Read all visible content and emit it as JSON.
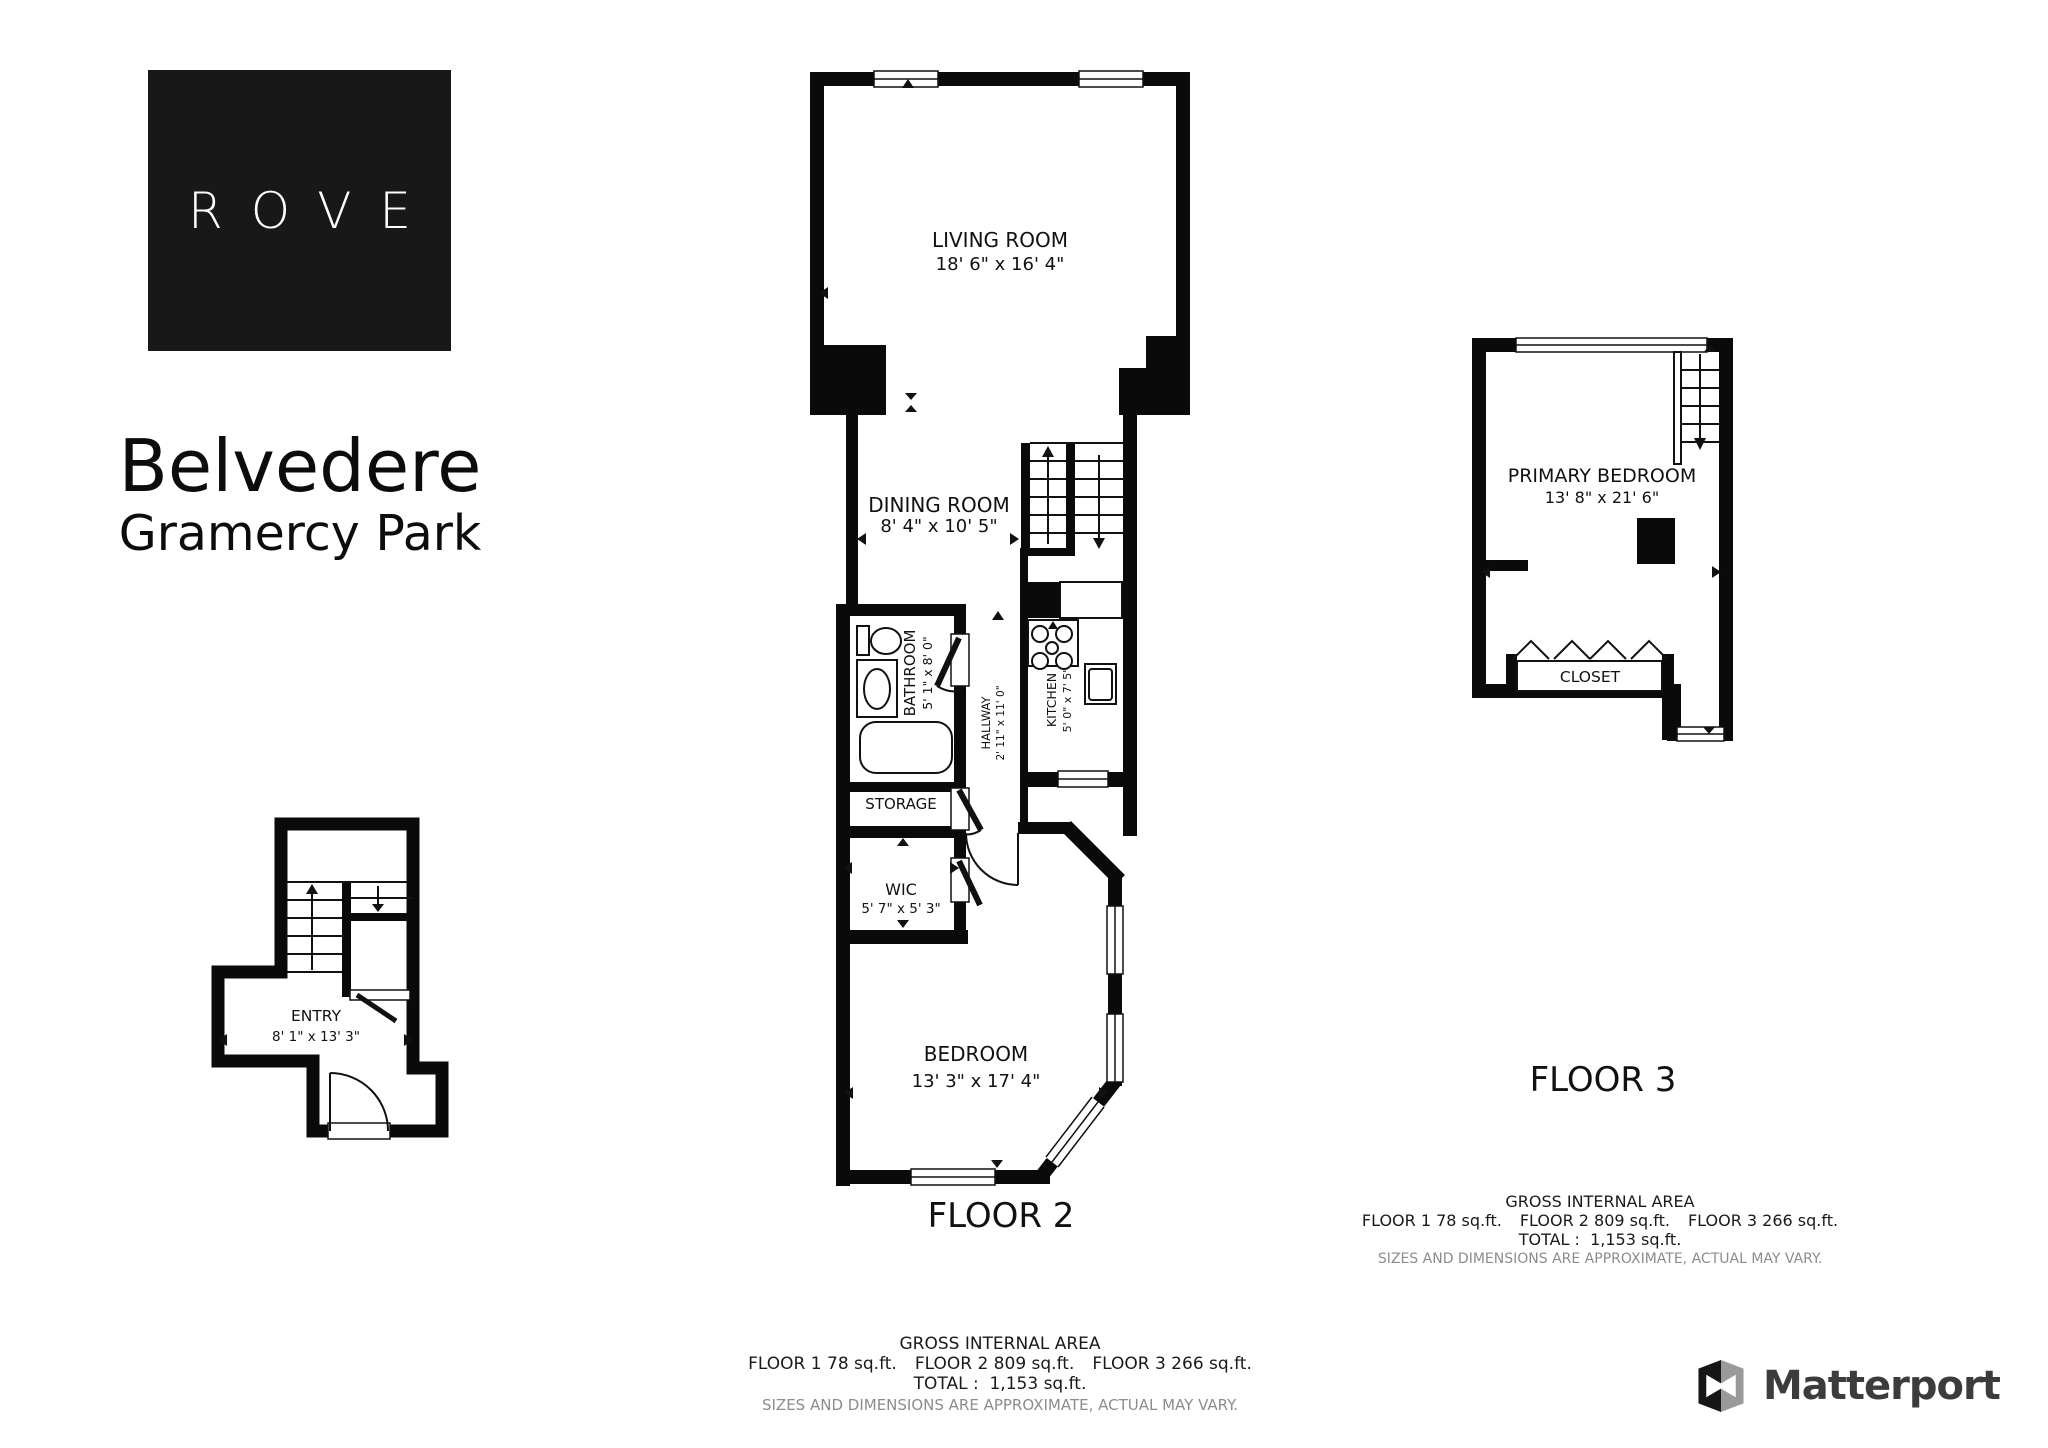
{
  "brand": {
    "logo_text": "ROVE",
    "matterport_label": "Matterport"
  },
  "title": {
    "line1": "Belvedere",
    "line2": "Gramercy Park"
  },
  "floors": {
    "floor1": {
      "rooms": {
        "entry": {
          "name": "ENTRY",
          "dims": "8' 1\" x 13' 3\""
        }
      }
    },
    "floor2": {
      "label": "FLOOR 2",
      "rooms": {
        "living_room": {
          "name": "LIVING ROOM",
          "dims": "18' 6\" x 16' 4\""
        },
        "dining_room": {
          "name": "DINING ROOM",
          "dims": "8' 4\" x 10' 5\""
        },
        "bathroom": {
          "name": "BATHROOM",
          "dims": "5' 1\" x 8' 0\""
        },
        "hallway": {
          "name": "HALLWAY",
          "dims": "2' 11\" x 11' 0\""
        },
        "kitchen": {
          "name": "KITCHEN",
          "dims": "5' 0\" x 7' 5\""
        },
        "storage": {
          "name": "STORAGE"
        },
        "wic": {
          "name": "WIC",
          "dims": "5' 7\" x 5' 3\""
        },
        "bedroom": {
          "name": "BEDROOM",
          "dims": "13' 3\" x 17' 4\""
        }
      }
    },
    "floor3": {
      "label": "FLOOR 3",
      "rooms": {
        "primary_bedroom": {
          "name": "PRIMARY BEDROOM",
          "dims": "13' 8\" x 21' 6\""
        },
        "closet": {
          "name": "CLOSET"
        }
      }
    }
  },
  "area_summary": {
    "heading": "GROSS INTERNAL AREA",
    "floors": [
      "FLOOR 1 78 sq.ft.",
      "FLOOR 2 809 sq.ft.",
      "FLOOR 3 266 sq.ft."
    ],
    "total": "TOTAL :  1,153 sq.ft.",
    "disclaimer": "SIZES AND DIMENSIONS ARE APPROXIMATE, ACTUAL MAY VARY."
  }
}
